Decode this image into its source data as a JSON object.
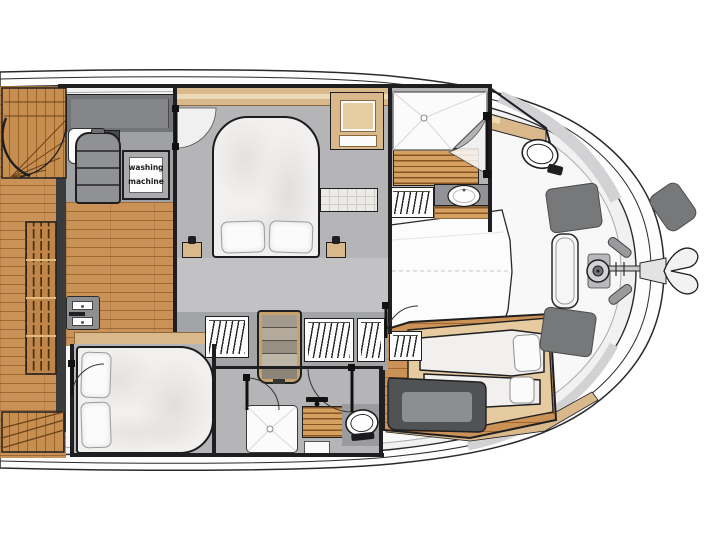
{
  "labels": {
    "washing_machine": "washing machine"
  },
  "colors": {
    "outline": "#1f1f21",
    "wood": "#cb9257",
    "wood_seam": "#a4692f",
    "wood_light": "#d9b98c",
    "wood_pale": "#ecd9b7",
    "teak": "#d6a061",
    "floor_gray": "#b5b5b7",
    "floor_gray_light": "#c2c2c4",
    "panel_gray": "#909194",
    "cabinet_gray": "#77787a",
    "dark_gray": "#515254",
    "bed": "#f1f0ee",
    "fixture_white": "#fbfbfc",
    "hull_deck": "#f1f1f2",
    "hull_shade": "#d2d2d4"
  },
  "icons": {
    "anchor_windlass": "anchor-windlass-icon",
    "anchor": "anchor-icon",
    "toilet_bow": "toilet-icon",
    "toilet_mid": "toilet-icon",
    "washbasin_fore": "sink-icon",
    "washbasin_mid": "sink-icon",
    "shower_fore": "shower-tray-icon",
    "shower_mid": "shower-tray-icon",
    "hanging_locker": "clothes-hanger-icon",
    "spiral_stairs": "stairs-icon",
    "stern_stairs": "stairs-icon",
    "deck_hatch": "hatch-icon",
    "electrical_panel": "switch-panel-icon"
  },
  "features": {
    "owner_bed": "double island berth with two pillows",
    "guest_bed_port": "double berth with two pillows",
    "guest_beds_bow": "two single berths with pillows",
    "bow_berth": "forward berth platform",
    "washing_machine": "front-load washer in utility space"
  }
}
